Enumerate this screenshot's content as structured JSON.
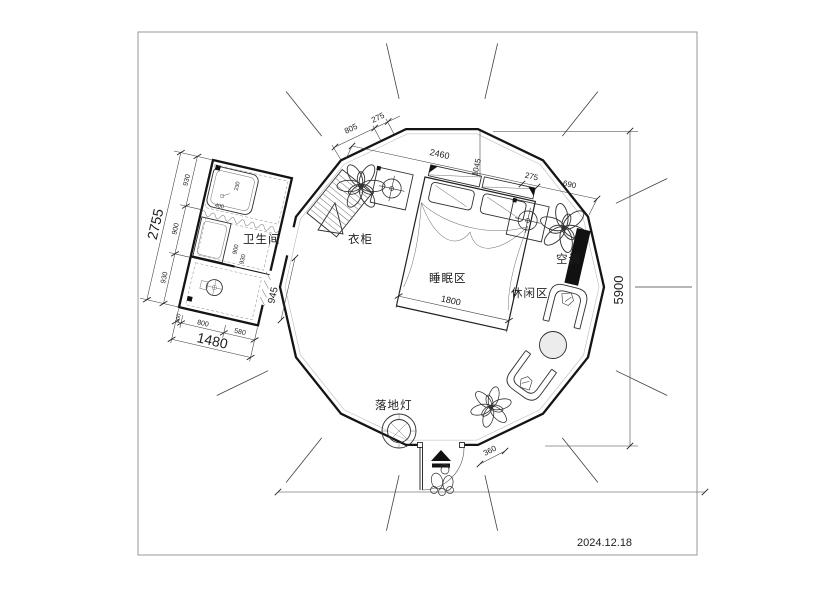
{
  "title_block": {
    "date": "2024.12.18"
  },
  "rooms": {
    "bathroom": "卫生间",
    "wardrobe": "衣柜",
    "sleeping": "睡眠区",
    "leisure": "休闲区",
    "air_conditioner": "空调",
    "floor_lamp": "落地灯"
  },
  "dims": {
    "overall_diameter": "5900",
    "bath_total_h": "2755",
    "bath_h1": "930",
    "bath_h2": "900",
    "bath_h3": "930",
    "bath_total_w": "1480",
    "bath_w1": "100",
    "bath_w2": "800",
    "bath_w3": "580",
    "door_passage": "945",
    "top_seg1": "805",
    "top_seg2": "275",
    "chain_main": "2460",
    "chain_offset": "1045",
    "right_seg1": "275",
    "right_seg2": "690",
    "bed_width": "1800",
    "entry_offset": "360",
    "shower_width": "550",
    "inner_900": "900",
    "inner_930": "930",
    "tub_400": "400",
    "tub_230": "230"
  }
}
